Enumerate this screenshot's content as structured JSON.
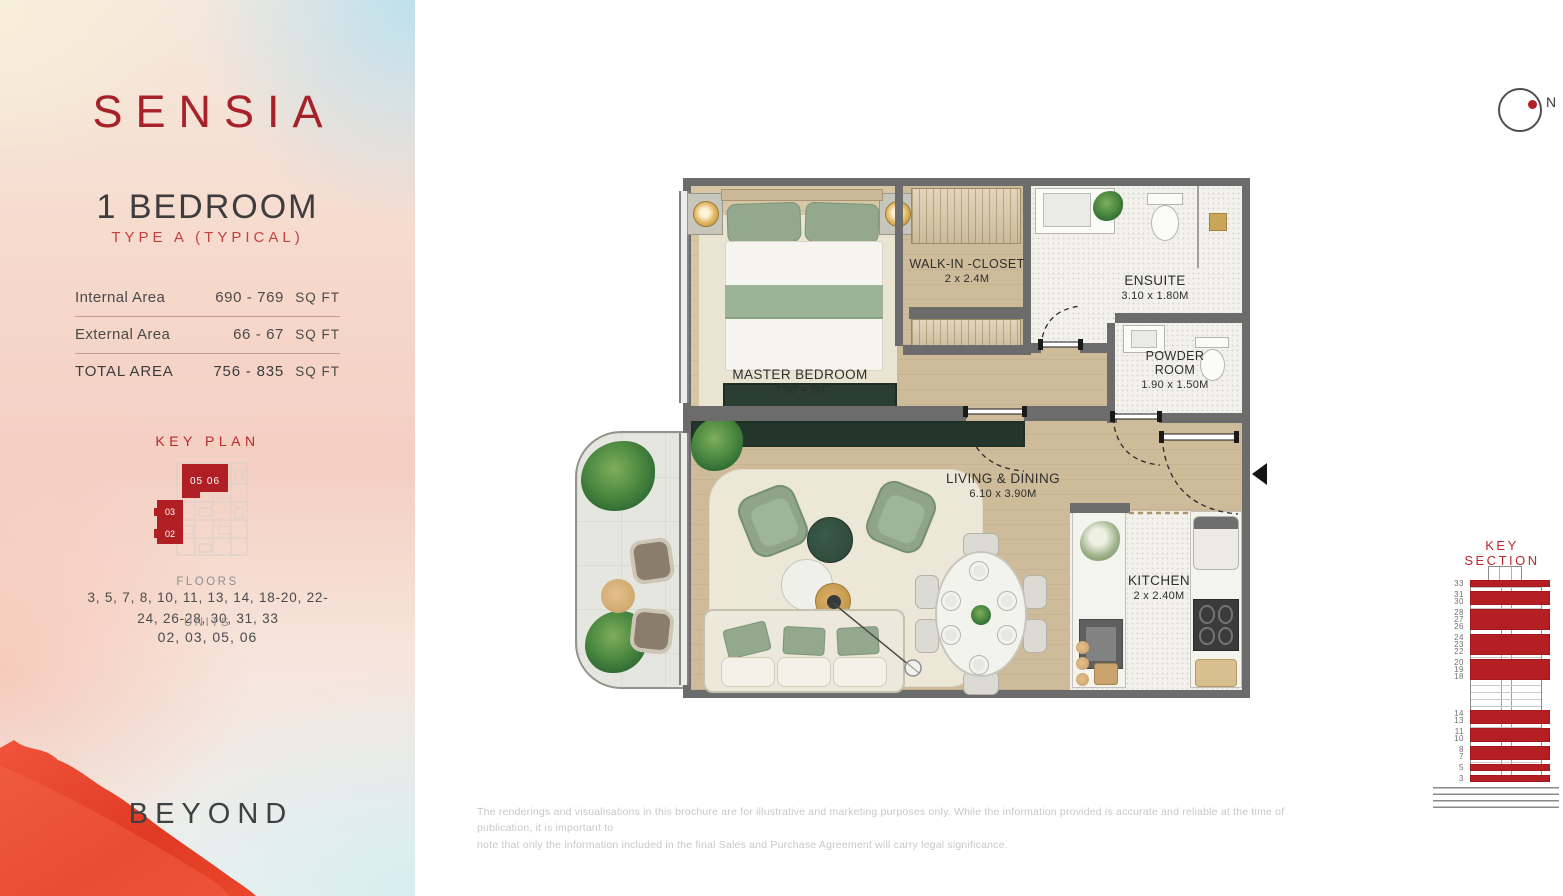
{
  "brand": {
    "logo_text": "SENSIA",
    "footer_logo": "BEYOND"
  },
  "sidebar": {
    "unit_title": "1 BEDROOM",
    "unit_subtitle": "TYPE A (TYPICAL)",
    "areas": [
      {
        "label": "Internal Area",
        "value": "690 - 769",
        "unit": "SQ FT"
      },
      {
        "label": "External Area",
        "value": "66 - 67",
        "unit": "SQ FT"
      },
      {
        "label": "TOTAL AREA",
        "value": "756 - 835",
        "unit": "SQ FT"
      }
    ],
    "key_plan": {
      "title": "KEY PLAN",
      "top_units": "05 06",
      "mid_unit": "03",
      "bottom_unit": "02"
    },
    "floors": {
      "label": "FLOORS",
      "value": "3, 5, 7, 8, 10, 11, 13, 14, 18-20, 22-24, 26-28, 30, 31, 33"
    },
    "units": {
      "label": "UNITS",
      "value": "02, 03, 05, 06"
    }
  },
  "plan": {
    "north_label": "N",
    "rooms": [
      {
        "name": "MASTER BEDROOM",
        "dims": "4.90 x 3M"
      },
      {
        "name": "WALK-IN -CLOSET",
        "dims": "2 x 2.4M"
      },
      {
        "name": "ENSUITE",
        "dims": "3.10 x 1.80M"
      },
      {
        "name": "POWDER ROOM",
        "dims": "1.90 x 1.50M"
      },
      {
        "name": "LIVING & DINING",
        "dims": "6.10 x 3.90M"
      },
      {
        "name": "KITCHEN",
        "dims": "2 x 2.40M"
      }
    ]
  },
  "key_section": {
    "title": "KEY SECTION",
    "groups": [
      [
        "33"
      ],
      [
        "31",
        "30"
      ],
      [
        "28",
        "27",
        "26"
      ],
      [
        "24",
        "23",
        "22"
      ],
      [
        "20",
        "19",
        "18"
      ],
      [
        "14",
        "13"
      ],
      [
        "11",
        "10"
      ],
      [
        "8",
        "7"
      ],
      [
        "5"
      ],
      [
        "3"
      ]
    ],
    "gap_after_group": 4
  },
  "disclaimer": "The renderings and visualisations in this brochure are for illustrative and marketing purposes only. While the information provided is accurate and reliable at the time of publication, it is important to\nnote that only the information included in the final Sales and Purchase Agreement will carry legal significance.",
  "colors": {
    "accent_red": "#b32025",
    "wall_gray": "#6c6c6c",
    "wood": "#cdbb9a",
    "sage": "#93a88e",
    "dark_green": "#2b3e33"
  }
}
